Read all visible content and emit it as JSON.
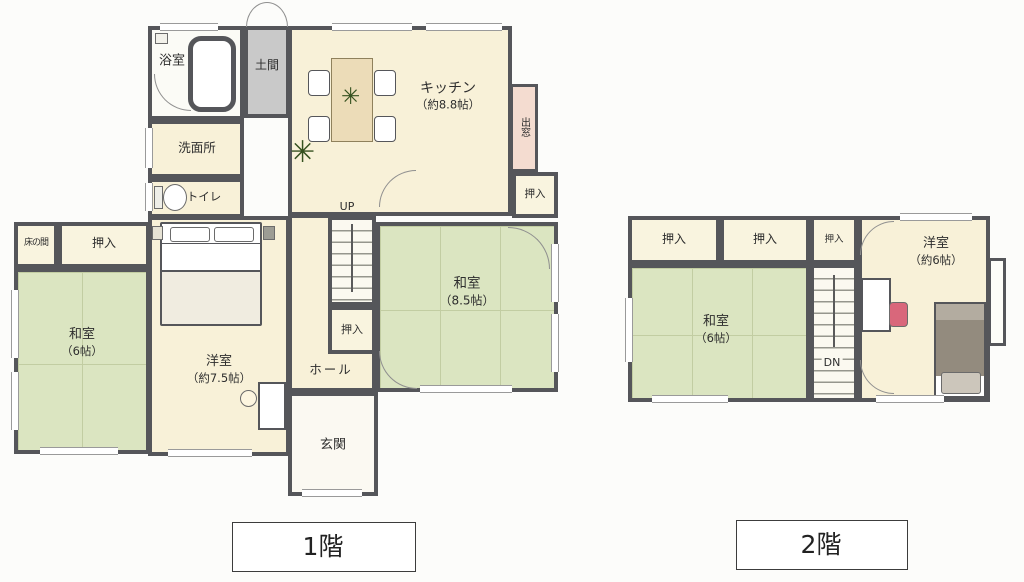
{
  "colors": {
    "wall": "#55565a",
    "tatami_green": "#dbe5c1",
    "wood_floor_cream": "#f8f1d8",
    "closet_cream": "#f9f4df",
    "doma_gray": "#c9c9c9",
    "bay_window_pink": "#f4dcd0",
    "bed_blanket_gray": "#938b7e",
    "chair_pink": "#d9677b"
  },
  "floor1": {
    "label": "1階",
    "bathroom": "浴室",
    "doma": "土間",
    "kitchen_name": "キッチン",
    "kitchen_size": "（約8.8帖）",
    "bay_window": "出窓",
    "washroom": "洗面所",
    "toilet": "トイレ",
    "closet_ne": "押入",
    "stairs_up": "UP",
    "closet_center": "押入",
    "washitsu85_name": "和室",
    "washitsu85_size": "（8.5帖）",
    "tokonoma": "床の間",
    "closet_west": "押入",
    "washitsu6_name": "和室",
    "washitsu6_size": "（6帖）",
    "youshitsu_name": "洋室",
    "youshitsu_size": "（約7.5帖）",
    "hall": "ホール",
    "genkan": "玄関"
  },
  "floor2": {
    "label": "2階",
    "closet_1": "押入",
    "closet_2": "押入",
    "closet_3": "押入",
    "washitsu6_name": "和室",
    "washitsu6_size": "（6帖）",
    "stairs_dn": "DN",
    "youshitsu_name": "洋室",
    "youshitsu_size": "（約6帖）"
  }
}
